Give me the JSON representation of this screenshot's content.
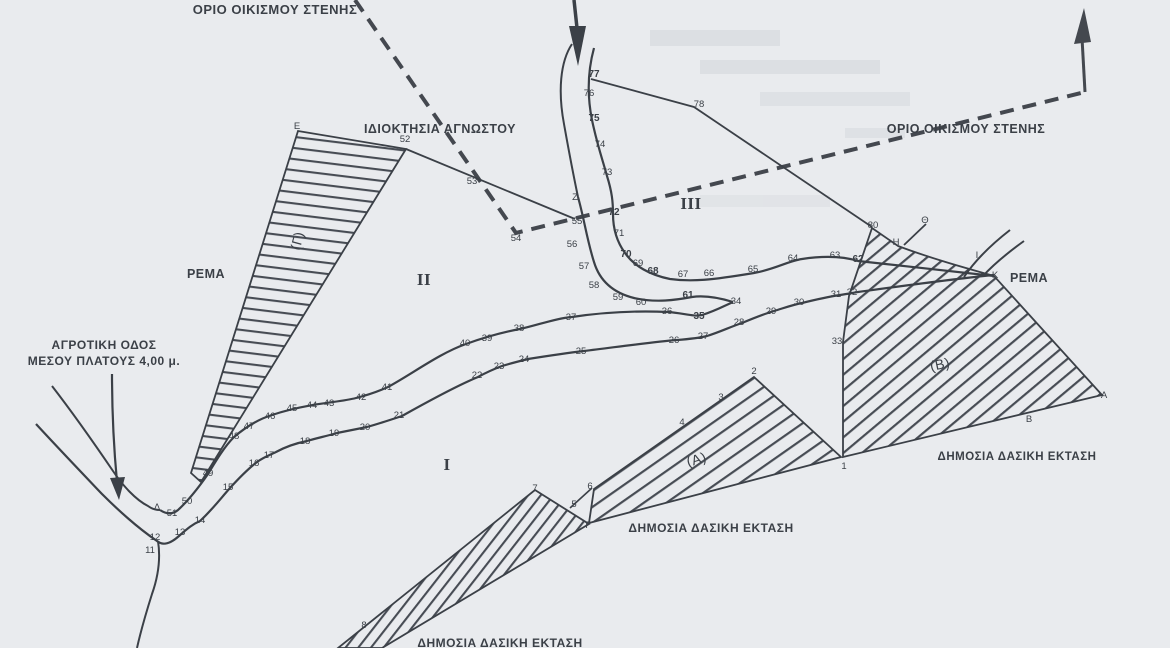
{
  "map": {
    "title_hint": "scanned Greek cadastral / forest survey sketch",
    "colors": {
      "paper": "#e9ebee",
      "ink": "#3b4047",
      "hatch": "#474c54",
      "dashed_boundary": "#44484f"
    },
    "labels": [
      {
        "name": "settlement-boundary-label-top-left",
        "text": "ΟΡΙΟ ΟΙΚΙΣΜΟΥ ΣΤΕΝΗΣ",
        "x": 275,
        "y": 14,
        "size": 13,
        "bold": true
      },
      {
        "name": "settlement-boundary-label-right",
        "text": "ΟΡΙΟ ΟΙΚΙΣΜΟΥ ΣΤΕΝΗΣ",
        "x": 966,
        "y": 133,
        "size": 12.5,
        "bold": true
      },
      {
        "name": "unknown-owner-label",
        "text": "ΙΔΙΟΚΤΗΣΙΑ ΑΓΝΩΣΤΟΥ",
        "x": 440,
        "y": 133,
        "size": 12.5,
        "bold": true
      },
      {
        "name": "stream-label-left",
        "text": "ΡΕΜΑ",
        "x": 206,
        "y": 278,
        "size": 12.5,
        "bold": true
      },
      {
        "name": "stream-label-right",
        "text": "ΡΕΜΑ",
        "x": 1029,
        "y": 282,
        "size": 12.5,
        "bold": true
      },
      {
        "name": "rural-road-label-line1",
        "text": "ΑΓΡΟΤΙΚΗ ΟΔΟΣ",
        "x": 104,
        "y": 349,
        "size": 12,
        "bold": true
      },
      {
        "name": "rural-road-label-line2",
        "text": "ΜΕΣΟΥ ΠΛΑΤΟΥΣ 4,00 μ.",
        "x": 104,
        "y": 365,
        "size": 12,
        "bold": true
      },
      {
        "name": "public-forest-label-center",
        "text": "ΔΗΜΟΣΙΑ ΔΑΣΙΚΗ ΕΚΤΑΣΗ",
        "x": 711,
        "y": 532,
        "size": 12,
        "bold": true
      },
      {
        "name": "public-forest-label-right",
        "text": "ΔΗΜΟΣΙΑ ΔΑΣΙΚΗ ΕΚΤΑΣΗ",
        "x": 1017,
        "y": 460,
        "size": 11.5,
        "bold": true
      },
      {
        "name": "public-forest-label-bottom",
        "text": "ΔΗΜΟΣΙΑ ΔΑΣΙΚΗ ΕΚΤΑΣΗ",
        "x": 500,
        "y": 647,
        "size": 12,
        "bold": true
      },
      {
        "name": "parcel-gamma-label",
        "text": "(Γ)",
        "x": 302,
        "y": 242,
        "size": 14,
        "rot": -75
      },
      {
        "name": "parcel-alpha-label",
        "text": "(Α)",
        "x": 698,
        "y": 464,
        "size": 14,
        "rot": -18
      },
      {
        "name": "parcel-beta-label",
        "text": "(Β)",
        "x": 941,
        "y": 369,
        "size": 14,
        "rot": -12
      },
      {
        "name": "zone-I-label",
        "text": "Ι",
        "x": 447,
        "y": 470,
        "size": 17,
        "roman": true
      },
      {
        "name": "zone-II-label",
        "text": "ΙΙ",
        "x": 424,
        "y": 285,
        "size": 17,
        "roman": true
      },
      {
        "name": "zone-III-label",
        "text": "ΙΙΙ",
        "x": 691,
        "y": 209,
        "size": 17,
        "roman": true
      }
    ],
    "points": [
      {
        "t": "Ε",
        "x": 297,
        "y": 129
      },
      {
        "t": "Ζ",
        "x": 575,
        "y": 200
      },
      {
        "t": "Η",
        "x": 896,
        "y": 245
      },
      {
        "t": "Θ",
        "x": 925,
        "y": 223
      },
      {
        "t": "Ι",
        "x": 977,
        "y": 258
      },
      {
        "t": "Κ",
        "x": 995,
        "y": 278
      },
      {
        "t": "Δ",
        "x": 157,
        "y": 510
      },
      {
        "t": "Γ",
        "x": 588,
        "y": 528
      },
      {
        "t": "Α",
        "x": 1104,
        "y": 398
      },
      {
        "t": "Β",
        "x": 1029,
        "y": 422
      },
      {
        "t": "1",
        "x": 844,
        "y": 469
      },
      {
        "t": "2",
        "x": 754,
        "y": 374
      },
      {
        "t": "3",
        "x": 721,
        "y": 400
      },
      {
        "t": "4",
        "x": 682,
        "y": 425
      },
      {
        "t": "5",
        "x": 574,
        "y": 507
      },
      {
        "t": "6",
        "x": 590,
        "y": 489
      },
      {
        "t": "7",
        "x": 535,
        "y": 491
      },
      {
        "t": "8",
        "x": 364,
        "y": 628
      },
      {
        "t": "11",
        "x": 150,
        "y": 553
      },
      {
        "t": "12",
        "x": 155,
        "y": 540
      },
      {
        "t": "13",
        "x": 180,
        "y": 535
      },
      {
        "t": "14",
        "x": 200,
        "y": 523
      },
      {
        "t": "15",
        "x": 228,
        "y": 490
      },
      {
        "t": "16",
        "x": 254,
        "y": 466
      },
      {
        "t": "17",
        "x": 269,
        "y": 458
      },
      {
        "t": "18",
        "x": 305,
        "y": 444
      },
      {
        "t": "19",
        "x": 334,
        "y": 436
      },
      {
        "t": "20",
        "x": 365,
        "y": 430
      },
      {
        "t": "21",
        "x": 399,
        "y": 418
      },
      {
        "t": "22",
        "x": 477,
        "y": 378
      },
      {
        "t": "23",
        "x": 499,
        "y": 369
      },
      {
        "t": "24",
        "x": 524,
        "y": 362
      },
      {
        "t": "25",
        "x": 581,
        "y": 354
      },
      {
        "t": "26",
        "x": 674,
        "y": 343
      },
      {
        "t": "27",
        "x": 703,
        "y": 339
      },
      {
        "t": "28",
        "x": 739,
        "y": 325
      },
      {
        "t": "29",
        "x": 771,
        "y": 314
      },
      {
        "t": "30",
        "x": 799,
        "y": 305
      },
      {
        "t": "31",
        "x": 836,
        "y": 297
      },
      {
        "t": "32",
        "x": 852,
        "y": 295
      },
      {
        "t": "33",
        "x": 837,
        "y": 344
      },
      {
        "t": "34",
        "x": 736,
        "y": 304
      },
      {
        "t": "35",
        "x": 699,
        "y": 319,
        "b": true
      },
      {
        "t": "36",
        "x": 667,
        "y": 314
      },
      {
        "t": "37",
        "x": 571,
        "y": 320
      },
      {
        "t": "38",
        "x": 519,
        "y": 331
      },
      {
        "t": "39",
        "x": 487,
        "y": 341
      },
      {
        "t": "40",
        "x": 465,
        "y": 346
      },
      {
        "t": "41",
        "x": 387,
        "y": 390
      },
      {
        "t": "42",
        "x": 361,
        "y": 400
      },
      {
        "t": "43",
        "x": 329,
        "y": 406
      },
      {
        "t": "44",
        "x": 312,
        "y": 408
      },
      {
        "t": "45",
        "x": 292,
        "y": 411
      },
      {
        "t": "46",
        "x": 270,
        "y": 419
      },
      {
        "t": "47",
        "x": 249,
        "y": 429
      },
      {
        "t": "48",
        "x": 234,
        "y": 439
      },
      {
        "t": "49",
        "x": 208,
        "y": 476
      },
      {
        "t": "50",
        "x": 187,
        "y": 504
      },
      {
        "t": "51",
        "x": 172,
        "y": 516
      },
      {
        "t": "52",
        "x": 405,
        "y": 142
      },
      {
        "t": "53",
        "x": 472,
        "y": 184
      },
      {
        "t": "54",
        "x": 516,
        "y": 241
      },
      {
        "t": "55",
        "x": 577,
        "y": 224
      },
      {
        "t": "56",
        "x": 572,
        "y": 247
      },
      {
        "t": "57",
        "x": 584,
        "y": 269
      },
      {
        "t": "58",
        "x": 594,
        "y": 288
      },
      {
        "t": "59",
        "x": 618,
        "y": 300
      },
      {
        "t": "60",
        "x": 641,
        "y": 305
      },
      {
        "t": "61",
        "x": 688,
        "y": 298,
        "b": true
      },
      {
        "t": "62",
        "x": 858,
        "y": 262,
        "b": true
      },
      {
        "t": "63",
        "x": 835,
        "y": 258
      },
      {
        "t": "64",
        "x": 793,
        "y": 261
      },
      {
        "t": "65",
        "x": 753,
        "y": 272
      },
      {
        "t": "66",
        "x": 709,
        "y": 276
      },
      {
        "t": "67",
        "x": 683,
        "y": 277
      },
      {
        "t": "68",
        "x": 653,
        "y": 274,
        "b": true
      },
      {
        "t": "69",
        "x": 638,
        "y": 266
      },
      {
        "t": "70",
        "x": 626,
        "y": 257,
        "b": true
      },
      {
        "t": "71",
        "x": 619,
        "y": 236
      },
      {
        "t": "72",
        "x": 614,
        "y": 215,
        "b": true
      },
      {
        "t": "73",
        "x": 607,
        "y": 175
      },
      {
        "t": "74",
        "x": 600,
        "y": 147
      },
      {
        "t": "75",
        "x": 594,
        "y": 121,
        "b": true
      },
      {
        "t": "76",
        "x": 589,
        "y": 96
      },
      {
        "t": "77",
        "x": 594,
        "y": 77,
        "b": true
      },
      {
        "t": "78",
        "x": 699,
        "y": 107
      },
      {
        "t": "80",
        "x": 873,
        "y": 228
      }
    ]
  }
}
